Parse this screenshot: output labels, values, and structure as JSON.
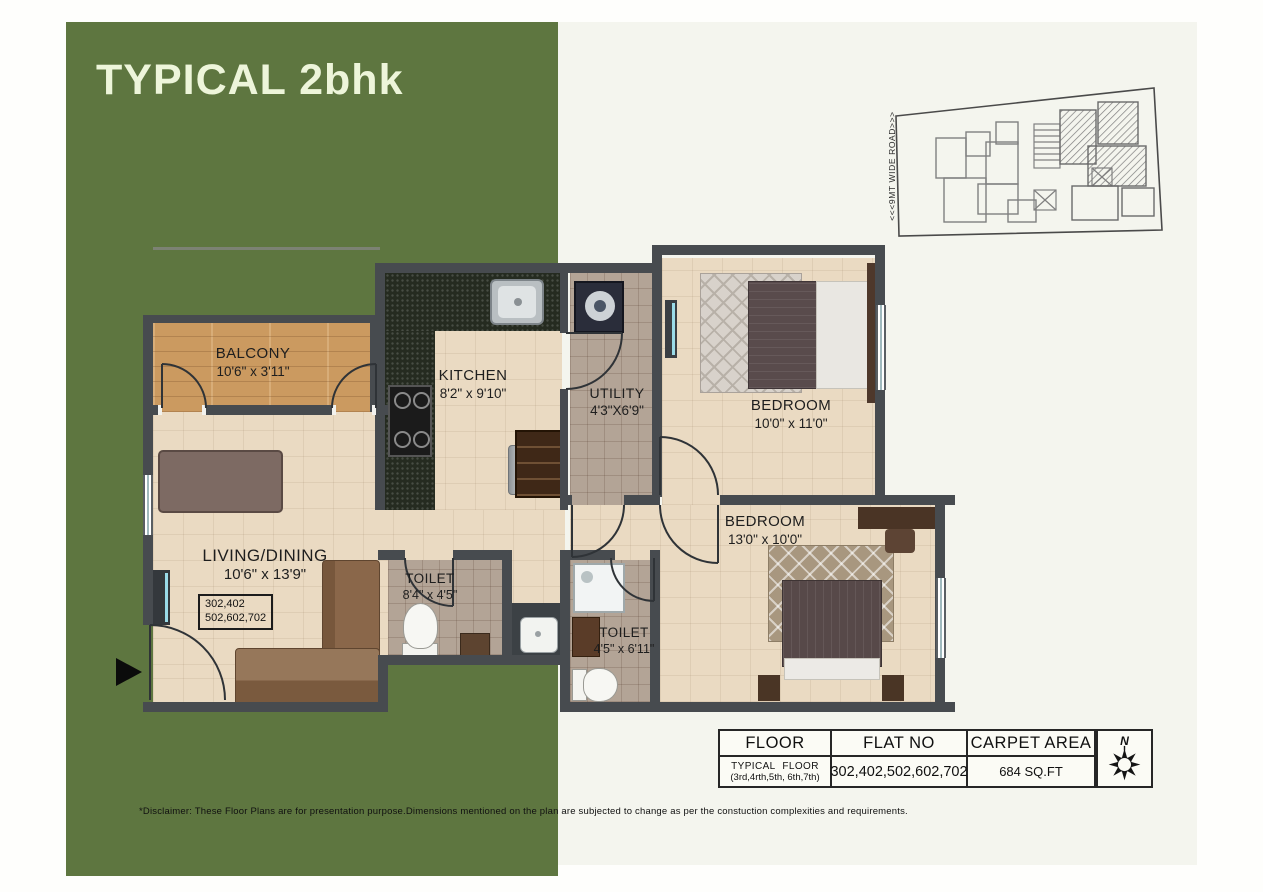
{
  "title": "TYPICAL 2bhk",
  "keyplan": {
    "road_label": "<<<9MT WIDE ROAD>>>"
  },
  "rooms": [
    {
      "id": "balcony",
      "name": "BALCONY",
      "dim": "10'6\" x 3'11\""
    },
    {
      "id": "kitchen",
      "name": "KITCHEN",
      "dim": "8'2\" x 9'10\""
    },
    {
      "id": "utility",
      "name": "UTILITY",
      "dim": "4'3\"X6'9\""
    },
    {
      "id": "bedroom1",
      "name": "BEDROOM",
      "dim": "10'0\" x 11'0\""
    },
    {
      "id": "living",
      "name": "LIVING/DINING",
      "dim": "10'6\" x 13'9\""
    },
    {
      "id": "toilet1",
      "name": "TOILET",
      "dim": "8'4\" x 4'5\""
    },
    {
      "id": "toilet2",
      "name": "TOILET",
      "dim": "4'5\" x 6'11\""
    },
    {
      "id": "bedroom2",
      "name": "BEDROOM",
      "dim": "13'0\" x 10'0\""
    }
  ],
  "unit_box": {
    "line1": "302,402",
    "line2": "502,602,702"
  },
  "spec_table": {
    "headers": [
      "FLOOR",
      "FLAT NO",
      "CARPET AREA"
    ],
    "row": {
      "floor_line1": "TYPICAL FLOOR",
      "floor_line2": "(3rd,4rth,5th, 6th,7th)",
      "flat_no": "302,402,502,602,702",
      "carpet_area": "684 SQ.FT"
    }
  },
  "compass": {
    "north_label": "N"
  },
  "disclaimer": "*Disclaimer: These Floor Plans are for presentation purpose.Dimensions mentioned on the plan are subjected to change as per the  constuction complexities and requirements.",
  "icons": {
    "entry_arrow": "right-pointing-triangle",
    "compass": "eight-point-star"
  },
  "colors": {
    "panel_green": "#5E7640",
    "panel_cream": "#F4F5EE",
    "title_text": "#EDF5DA",
    "wall": "#474B4F",
    "floor_beige": "#EADAC2",
    "floor_wood": "#CB9A60",
    "floor_tile": "#B3A496",
    "granite": "#252B20",
    "bed_blanket": "#574949",
    "pillow_dark": "#3F3837",
    "wardrobe_wood": "#B5803A",
    "sofa_brown": "#8A674A",
    "plate_green": "#B8C437",
    "screen_cyan": "#9ADBE8"
  }
}
